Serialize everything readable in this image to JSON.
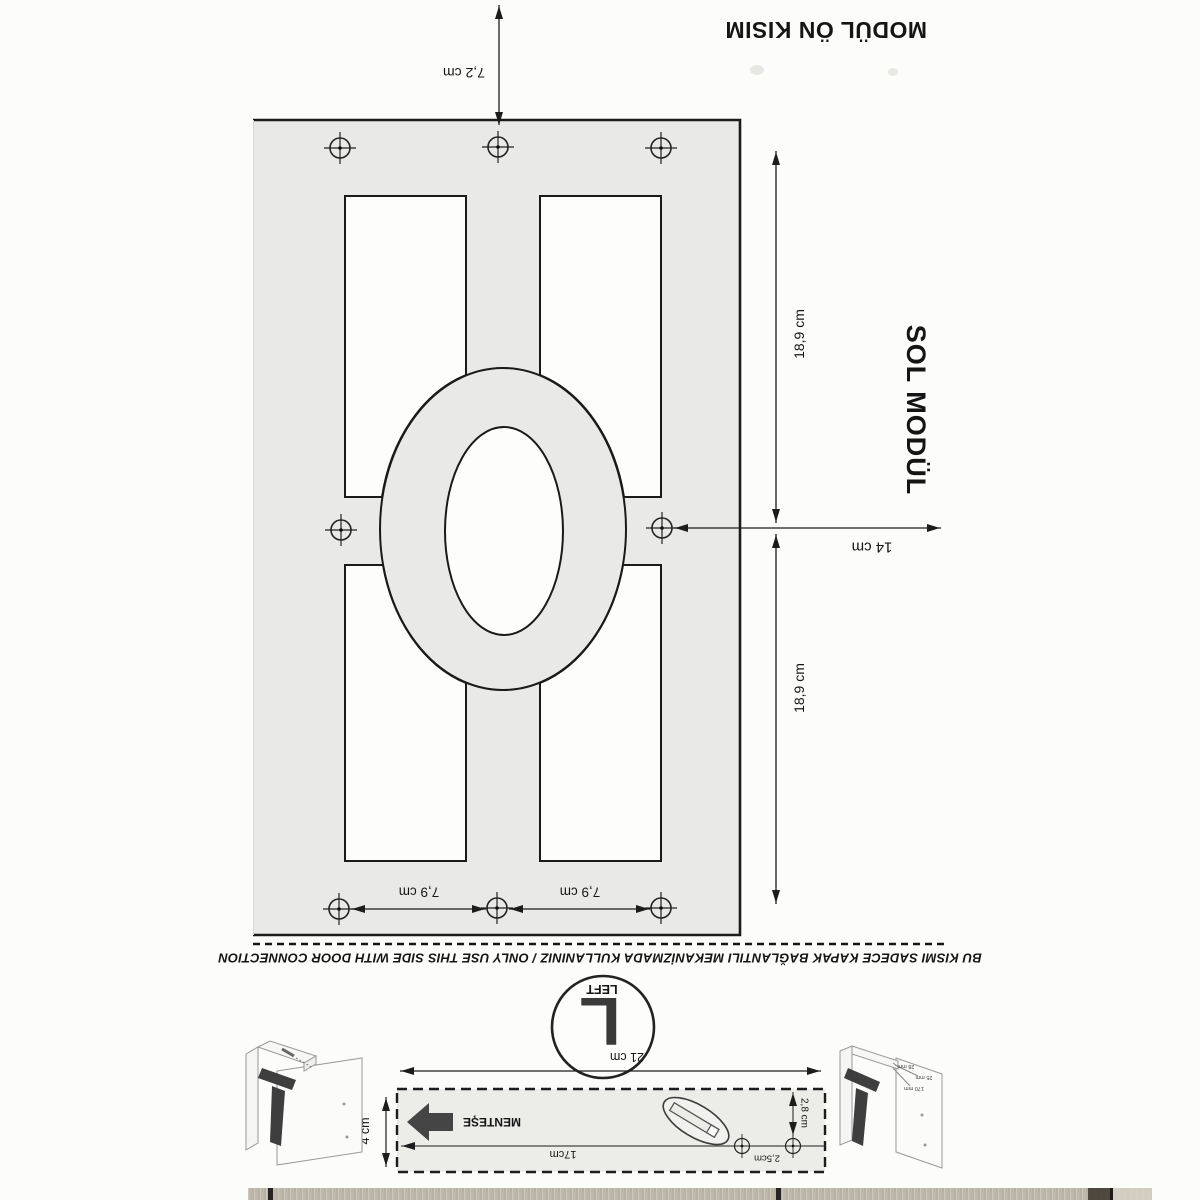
{
  "page": {
    "title_top": "MODÜL ÖN KISIM",
    "title_side": "SOL MODÜL",
    "separator_note": "BU KISMI SADECE KAPAK BAĞLANTILI MEKANİZMADA KULLANINIZ / ONLY USE THIS SIDE WITH DOOR CONNECTION"
  },
  "dimensions": {
    "top_edge": "7,2 cm",
    "right_upper": "18,9 cm",
    "right_lower": "18,9 cm",
    "center_width": "14 cm",
    "bottom_left_span": "7,9 cm",
    "bottom_right_span": "7,9 cm"
  },
  "side_badge": {
    "letter": "L",
    "label": "LEFT"
  },
  "hinge_template": {
    "total_width": "21 cm",
    "inner_length": "17cm",
    "hole_spacing": "2,5cm",
    "hole_offset": "2,8 cm",
    "strip_height": "4 cm",
    "hinge_label": "MENTEŞE"
  },
  "cabinet_diagram": {
    "labels": [
      "28 mm",
      "25 mm",
      "170 mm"
    ]
  },
  "colors": {
    "sheet": "#e9e9e7",
    "line": "#1c1c1c",
    "hinge_dark": "#434343",
    "wood_base": "#ccc7ba"
  }
}
